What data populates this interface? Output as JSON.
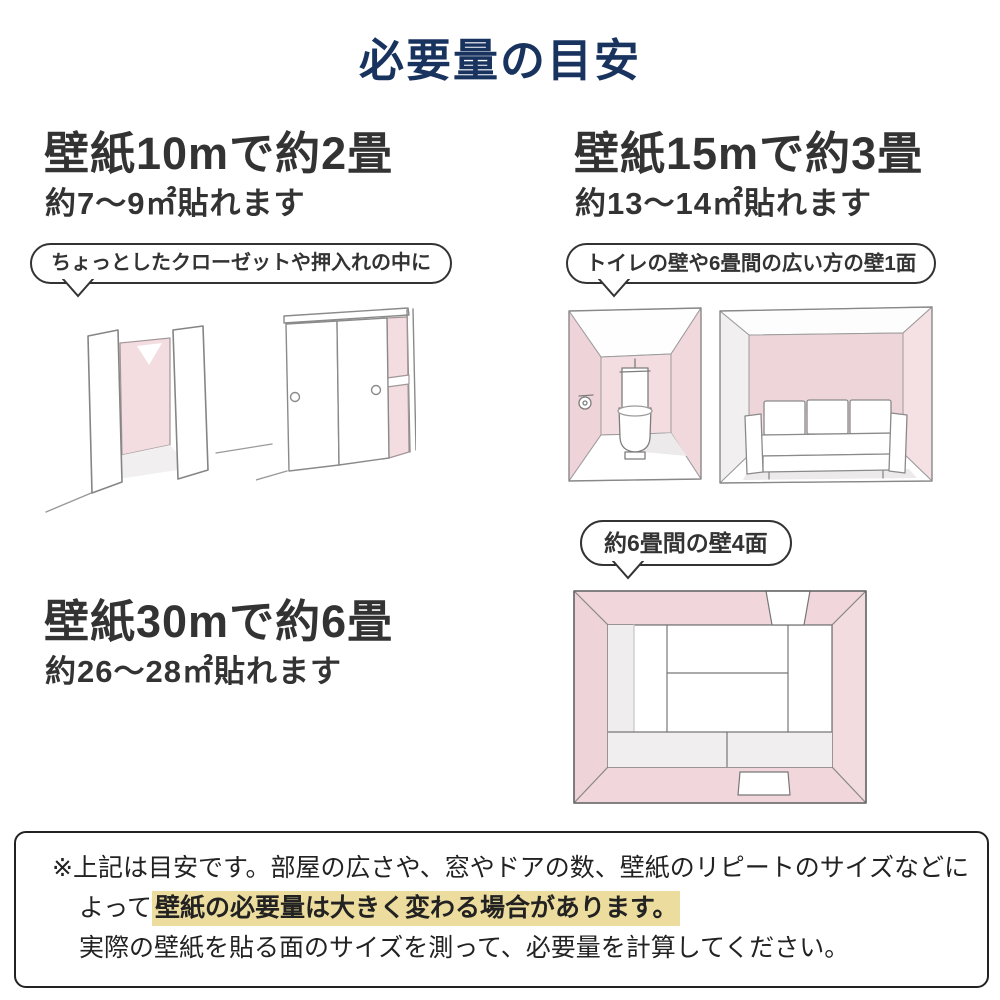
{
  "page": {
    "title": "必要量の目安"
  },
  "colors": {
    "title_navy": "#19335f",
    "body_text": "#333333",
    "highlight_yellow": "#ecdc9e",
    "wall_pink": "#f3dde0",
    "wall_pink_shaded": "#eed3d8",
    "outline_gray": "#888888",
    "note_border": "#222222"
  },
  "sections": [
    {
      "headline": "壁紙10mで約2畳",
      "subline": "約7～9㎡貼れます",
      "bubble": "ちょっとしたクローゼットや押入れの中に",
      "illustrations": [
        "open-closet-illustration",
        "sliding-closet-illustration"
      ]
    },
    {
      "headline": "壁紙15mで約3畳",
      "subline": "約13～14㎡貼れます",
      "bubble": "トイレの壁や6畳間の広い方の壁1面",
      "illustrations": [
        "toilet-room-illustration",
        "sofa-room-illustration"
      ]
    },
    {
      "headline": "壁紙30mで約6畳",
      "subline": "約26～28㎡貼れます",
      "bubble": "約6畳間の壁4面",
      "illustrations": [
        "tatami-room-illustration"
      ]
    }
  ],
  "note": {
    "line1": "※上記は目安です。部屋の広さや、窓やドアの数、壁紙のリピートのサイズなどに",
    "line2_prefix": "よって",
    "line2_highlight": "壁紙の必要量は大きく変わる場合があります。",
    "line3": "実際の壁紙を貼る面のサイズを測って、必要量を計算してください。"
  }
}
